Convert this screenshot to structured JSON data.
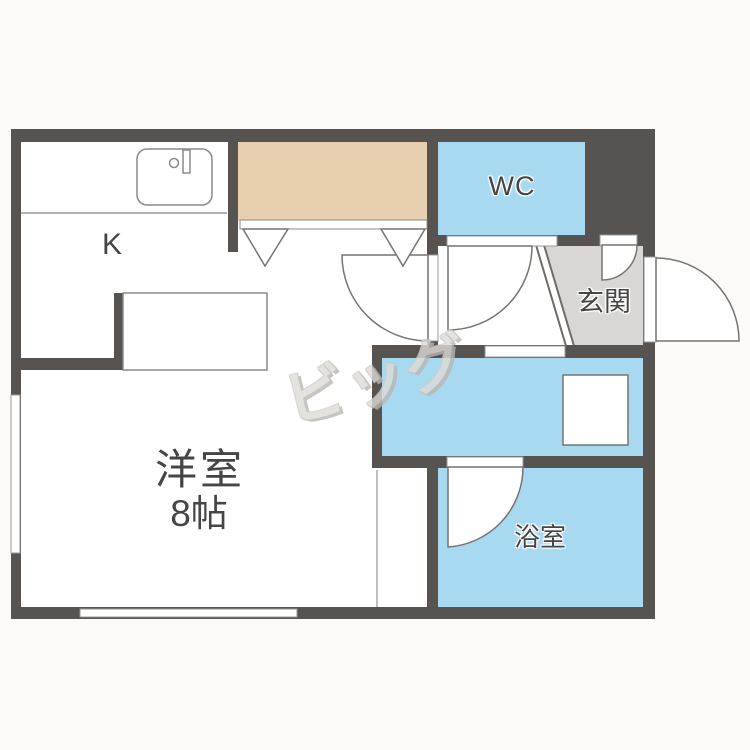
{
  "floorplan": {
    "labels": {
      "kitchen": "K",
      "wc": "WC",
      "entrance": "玄関",
      "main_room": "洋室",
      "main_room_size": "8帖",
      "bathroom": "浴室"
    },
    "watermark": "ビッグ",
    "colors": {
      "wall": "#575350",
      "wet_room_floor": "#a7d9f1",
      "closet_floor": "#e7cfaf",
      "entrance_floor": "#d8d7d5",
      "room_floor": "#ffffff",
      "label_text": "#454545",
      "fixture_line": "#8a8a8a"
    }
  }
}
